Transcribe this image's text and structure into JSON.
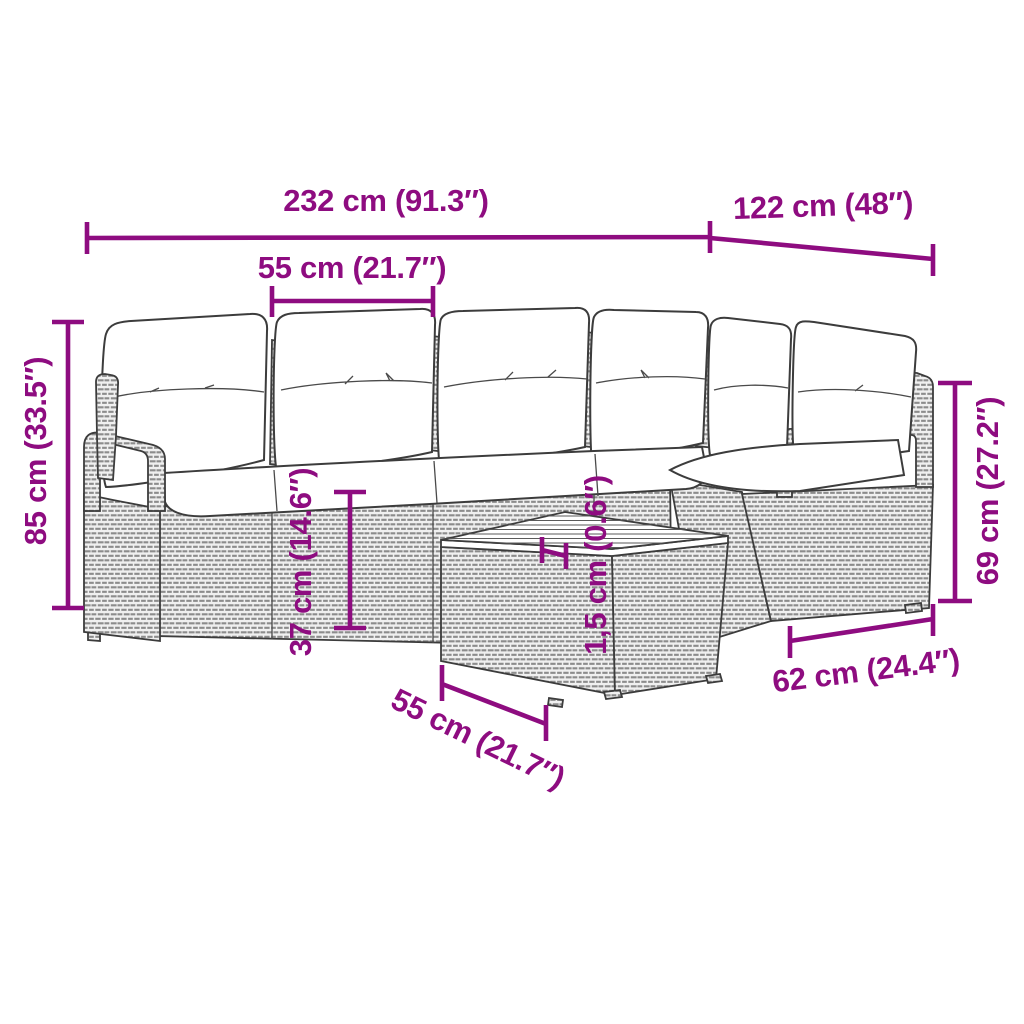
{
  "diagram": {
    "type": "product-dimension-diagram",
    "subject": "poly rattan garden sofa set with back cushions, seat cushions and square coffee table with slatted wood top",
    "colors": {
      "dimension": "#8E0C80",
      "lineart": "#3c3c3c",
      "wicker": "#8c8c8c",
      "panel": "#f0f0f0"
    },
    "measurements": {
      "total_width": "232 cm (91.3″)",
      "total_depth": "122 cm (48″)",
      "seat_width": "55 cm (21.7″)",
      "total_height": "85 cm (33.5″)",
      "seat_height": "37 cm (14.6″)",
      "tabletop_thickness": "1,5 cm (0.6″)",
      "back_height": "69 cm (27.2″)",
      "unit_depth": "62 cm (24.4″)",
      "table_width": "55 cm (21.7″)"
    }
  }
}
